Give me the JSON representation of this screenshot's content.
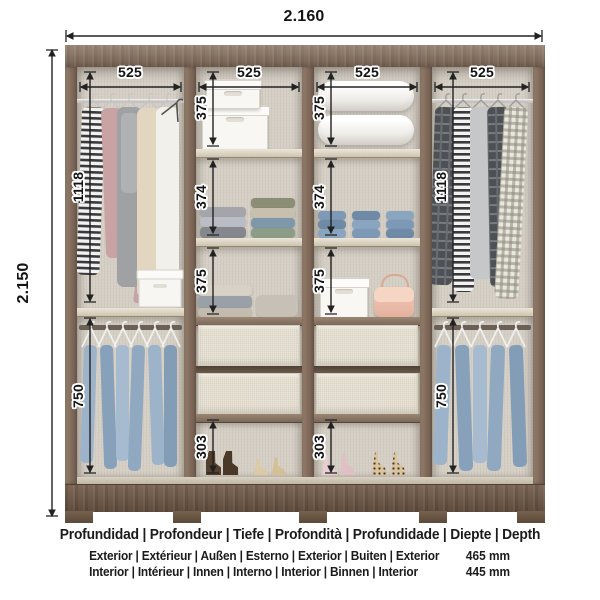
{
  "dims": {
    "total_width": "2.160",
    "total_height": "2.150",
    "section_widths": [
      "525",
      "525",
      "525",
      "525"
    ],
    "sec1_hang_top": "1118",
    "sec1_hang_bottom": "750",
    "sec2_comp1": "375",
    "sec2_comp2": "374",
    "sec2_comp3": "375",
    "sec2_shoe": "303",
    "sec3_comp1": "375",
    "sec3_comp2": "374",
    "sec3_comp3": "375",
    "sec3_shoe": "303",
    "sec4_hang_top": "1118",
    "sec4_hang_bottom": "750"
  },
  "footer": {
    "depth_title": "Profundidad | Profondeur | Tiefe | Profondità | Profundidade | Diepte | Depth",
    "exterior_label": "Exterior | Extérieur | Außen | Esterno | Exterior | Buiten | Exterior",
    "exterior_value": "465 mm",
    "interior_label": "Interior | Intérieur | Innen | Interno | Interior | Binnen | Interior",
    "interior_value": "445 mm"
  },
  "colors": {
    "dimension_line": "#222222",
    "wood_dark": "#6b5747",
    "wood_frame": "#87705f",
    "interior_back": "#d5cfc5",
    "shelf": "#e0d8c8",
    "drawer_front": "#eae5d8",
    "denim": "#9cb3ca",
    "text": "#1b1b1b"
  }
}
